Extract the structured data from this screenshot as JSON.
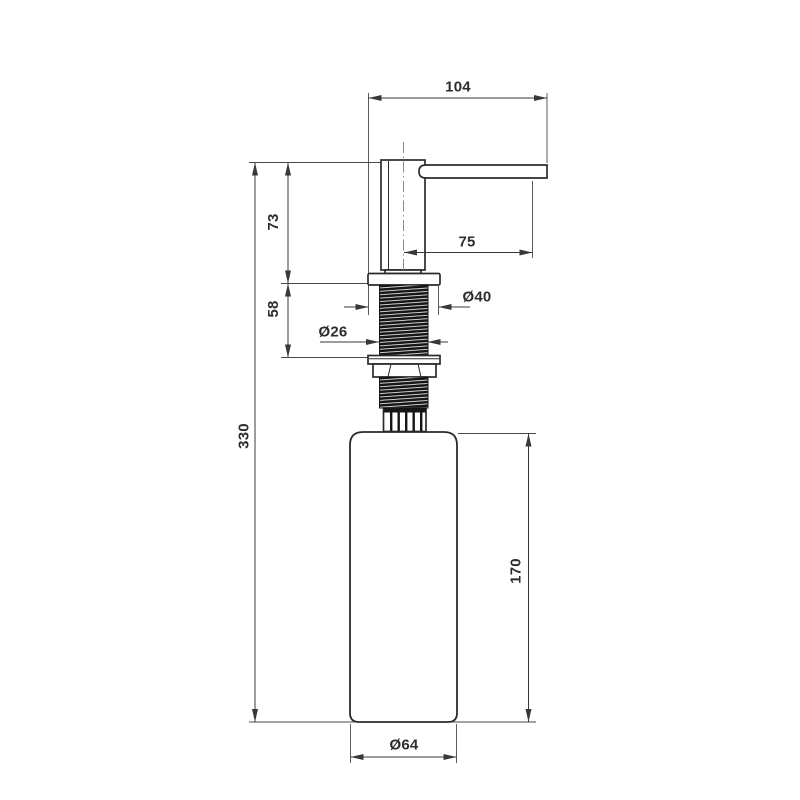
{
  "drawing": {
    "background": "#ffffff",
    "outline_color": "#2b2b2b",
    "dimension_color": "#383838",
    "thread_fill": "#161616",
    "labels": {
      "total_width": "104",
      "head_height": "73",
      "spout_reach": "75",
      "flange_diameter": "Ø40",
      "thread_diameter": "Ø26",
      "thread_length": "58",
      "total_height": "330",
      "bottle_height": "170",
      "bottle_diameter": "Ø64"
    }
  }
}
